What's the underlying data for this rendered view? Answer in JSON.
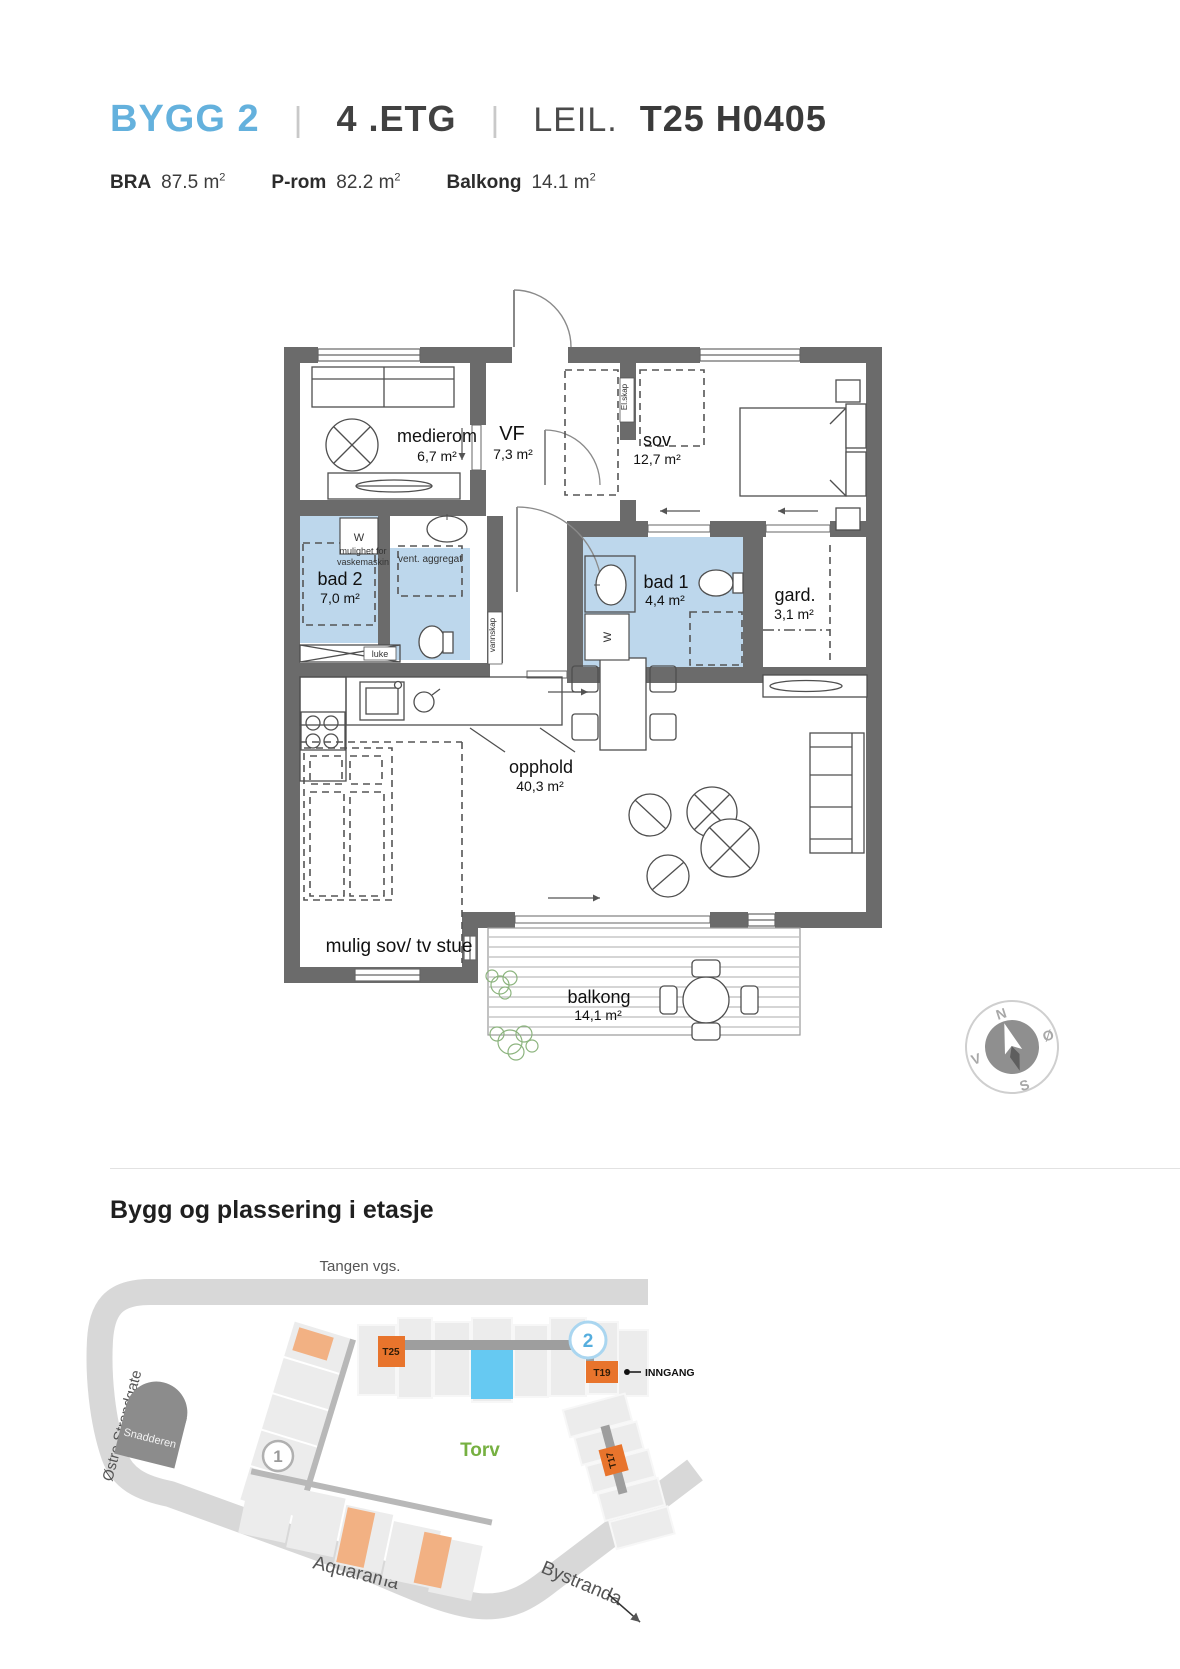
{
  "header": {
    "building": "BYGG 2",
    "divider": "|",
    "floor": "4 .ETG",
    "unit_label": "LEIL.",
    "unit_id": "T25 H0405",
    "unit": "m",
    "sup": "2",
    "metrics": [
      {
        "label": "BRA",
        "value": "87.5"
      },
      {
        "label": "P-rom",
        "value": "82.2"
      },
      {
        "label": "Balkong",
        "value": "14.1"
      }
    ]
  },
  "floorplan": {
    "rooms": [
      {
        "name": "medierom",
        "area": "6,7 m²"
      },
      {
        "name": "VF",
        "area": "7,3 m²"
      },
      {
        "name": "sov",
        "area": "12,7 m²"
      },
      {
        "name": "bad 2",
        "area": "7,0 m²"
      },
      {
        "name": "bad 1",
        "area": "4,4 m²"
      },
      {
        "name": "gard.",
        "area": "3,1 m²"
      },
      {
        "name": "opphold",
        "area": "40,3 m²"
      },
      {
        "name": "mulig sov/ tv stue",
        "area": ""
      },
      {
        "name": "balkong",
        "area": "14,1 m²"
      }
    ],
    "annotations": {
      "w": "W",
      "laundry_line1": "mulighet for",
      "laundry_line2": "vaskemaskin",
      "vent": "vent. aggregat",
      "luke": "luke",
      "el_skap": "El.skap",
      "vannskap": "vannskap"
    },
    "compass": {
      "n": "N",
      "east": "Ø",
      "s": "S",
      "west": "V"
    }
  },
  "sitemap": {
    "heading": "Bygg og plassering i etasje",
    "labels": {
      "tangen_vgs": "Tangen vgs.",
      "ostre_strandgate": "Østre Strandgate",
      "snadderen": "Snadderen",
      "torv": "Torv",
      "tangen": "Tangen",
      "aquarama": "Aquarama",
      "bystranda": "Bystranda",
      "inngang": "INNGANG"
    },
    "markers": {
      "bygg1": "1",
      "bygg2": "2",
      "t25": "T25",
      "t19": "T19",
      "t17": "T17"
    },
    "colors": {
      "road": "#d8d8d8",
      "building": "#ececec",
      "dark_building": "#8c8c8c",
      "corridor": "#9e9e9e",
      "unit_orange": "#e8742c",
      "unit_orange_light": "#f2b183",
      "pool_blue": "#66c9f2",
      "torv_green": "#76b041",
      "accent_blue": "#64b1dd",
      "bath_blue": "#bdd7ec",
      "wall_gray": "#6b6b6b"
    }
  }
}
